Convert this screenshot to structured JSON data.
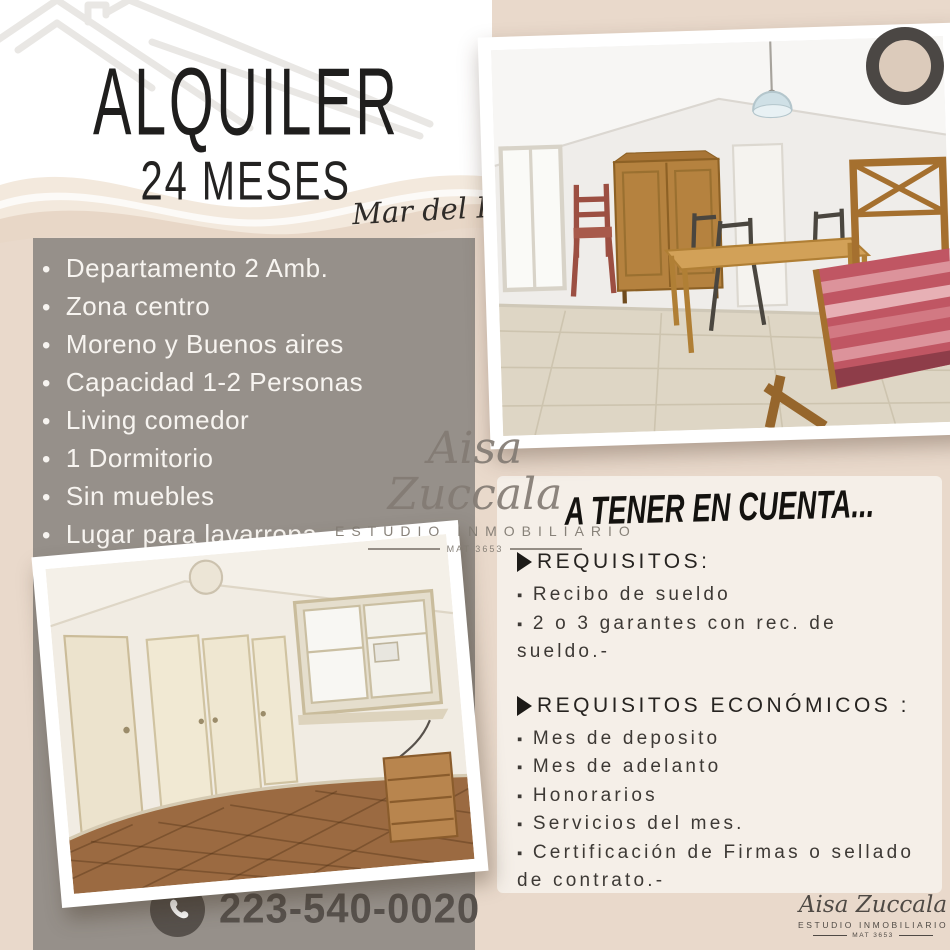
{
  "poster": {
    "title": "ALQUILER",
    "subtitle": "24 MESES",
    "location": "Mar del Plata"
  },
  "features": [
    "Departamento 2 Amb.",
    "Zona centro",
    "Moreno y Buenos aires",
    "Capacidad 1-2 Personas",
    "Living comedor",
    "1 Dormitorio",
    "Sin muebles",
    "Lugar para lavarropa"
  ],
  "brand": {
    "name": "Aisa Zuccala",
    "tagline": "ESTUDIO INMOBILIARIO",
    "license": "MAT 3653"
  },
  "notice": {
    "heading": "A TENER EN CUENTA...",
    "sections": [
      {
        "title": "REQUISITOS:",
        "items": [
          "Recibo de sueldo",
          "2 o 3 garantes con rec. de sueldo.-"
        ]
      },
      {
        "title": "REQUISITOS ECONÓMICOS :",
        "items": [
          "Mes de deposito",
          "Mes de adelanto",
          "Honorarios",
          "Servicios del mes.",
          "Certificación de Firmas o sellado de contrato.-"
        ]
      }
    ]
  },
  "contact": {
    "phone": "223-540-0020"
  },
  "colors": {
    "background_beige": "#e9d9cb",
    "top_white": "#ffffff",
    "gray_box": "#96908a",
    "panel_cream": "#f5efe8",
    "text_dark": "#1f1e1d",
    "phone_gray": "#57514c",
    "ring_dark": "#4b4744",
    "bed_cover_red": "#c05663"
  }
}
